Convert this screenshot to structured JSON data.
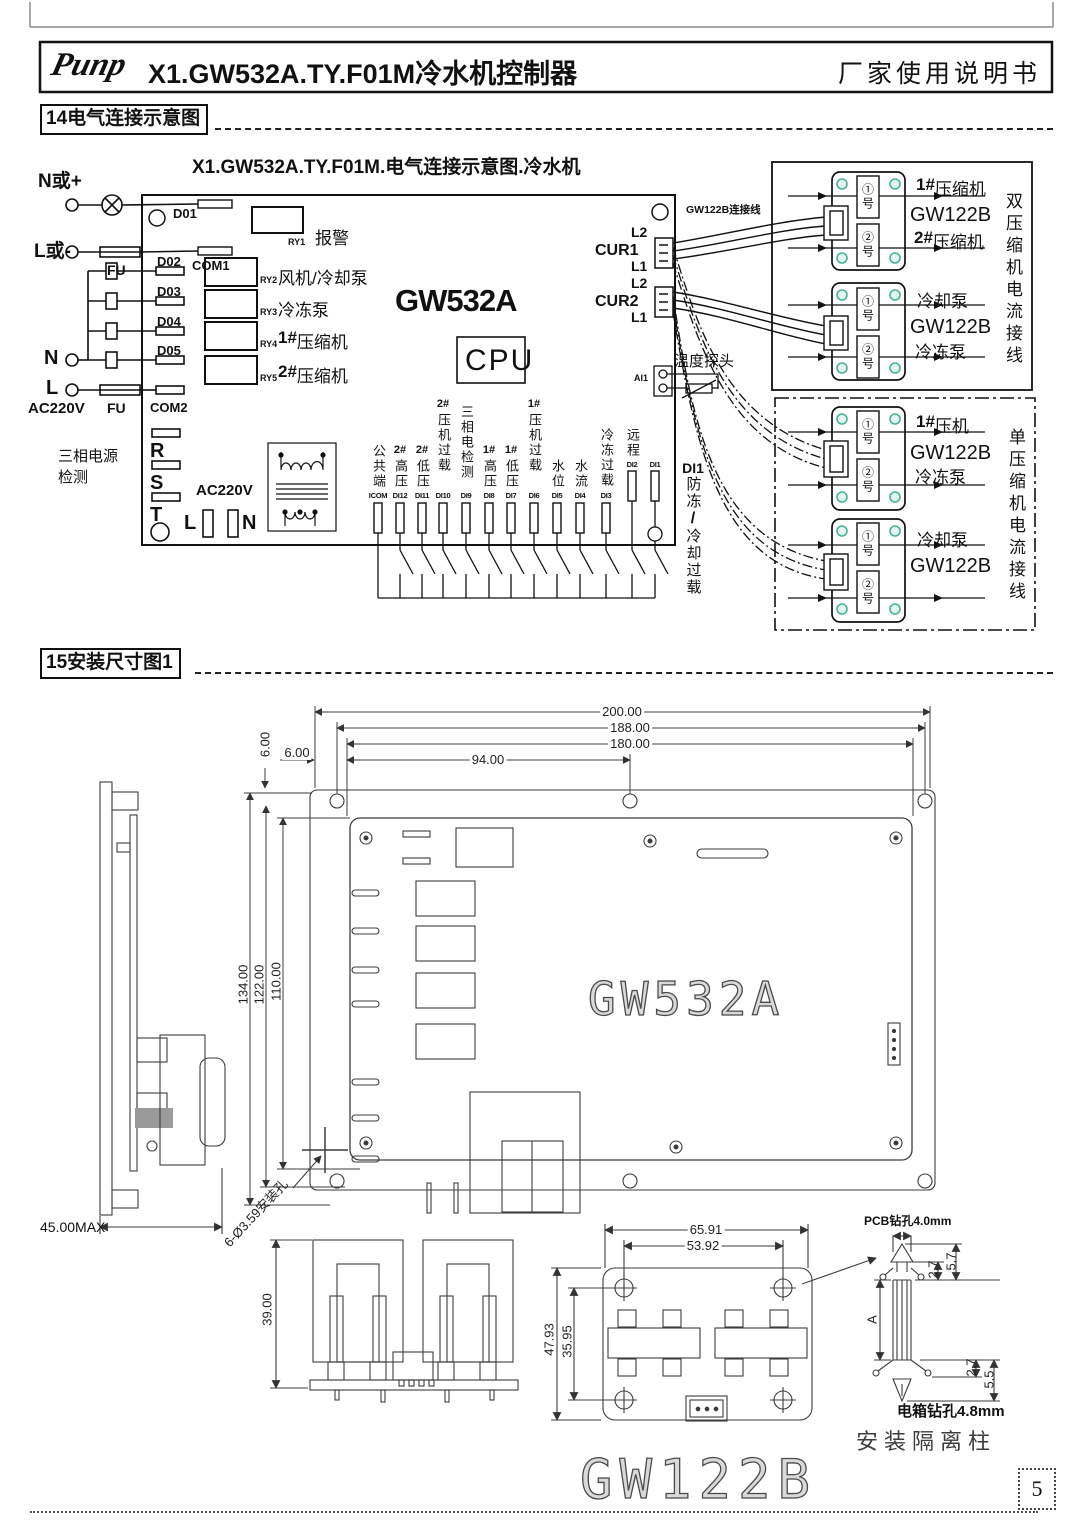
{
  "header": {
    "logo": "Punp",
    "title": "X1.GW532A.TY.F01M冷水机控制器",
    "manual": "厂家使用说明书"
  },
  "sec14": {
    "heading": "14电气连接示意图",
    "diagram_title": "X1.GW532A.TY.F01M.电气连接示意图.冷水机",
    "power": {
      "n_plus": "N或+",
      "l_minus": "L或-",
      "fu_top": "FU",
      "fu_bottom": "FU",
      "n": "N",
      "l": "L",
      "ac220v": "AC220V",
      "three_phase_1": "三相电源",
      "three_phase_2": "检测"
    },
    "board": {
      "name": "GW532A",
      "cpu": "CPU",
      "d01": "D01",
      "com1": "COM1",
      "d02": "D02",
      "d03": "D03",
      "d04": "D04",
      "d05": "D05",
      "com2": "COM2",
      "r": "R",
      "s": "S",
      "t": "T",
      "ac220v": "AC220V",
      "l": "L",
      "n": "N"
    },
    "relays": [
      {
        "id": "RY1",
        "prefix": "",
        "name": "报警"
      },
      {
        "id": "RY2",
        "prefix": "",
        "name": "风机/冷却泵"
      },
      {
        "id": "RY3",
        "prefix": "",
        "name": "冷冻泵"
      },
      {
        "id": "RY4",
        "prefix": "1#",
        "name": "压缩机"
      },
      {
        "id": "RY5",
        "prefix": "2#",
        "name": "压缩机"
      }
    ],
    "cur": {
      "cur1": "CUR1",
      "cur2": "CUR2",
      "l2a": "L2",
      "l1a": "L1",
      "l2b": "L2",
      "l1b": "L1",
      "cable": "GW122B连接线",
      "probe": "温度探头",
      "ai1": "AI1"
    },
    "di1_note": {
      "id": "DI1",
      "line1": "防冻",
      "slash": "/",
      "line2": "冷却过载"
    },
    "terminals": [
      {
        "prefix": "",
        "label": "公共端",
        "id": "ICOM"
      },
      {
        "prefix": "2#",
        "label": "高压",
        "id": "DI12"
      },
      {
        "prefix": "2#",
        "label": "低压",
        "id": "DI11"
      },
      {
        "prefix": "2#",
        "label": "压机过载",
        "id": "DI10"
      },
      {
        "prefix": "",
        "label": "三相电检测",
        "id": "DI9"
      },
      {
        "prefix": "1#",
        "label": "高压",
        "id": "DI8"
      },
      {
        "prefix": "1#",
        "label": "低压",
        "id": "DI7"
      },
      {
        "prefix": "1#",
        "label": "压机过载",
        "id": "DI6"
      },
      {
        "prefix": "",
        "label": "水位",
        "id": "DI5"
      },
      {
        "prefix": "",
        "label": "水流",
        "id": "DI4"
      },
      {
        "prefix": "",
        "label": "冷冻过载",
        "id": "DI3"
      },
      {
        "prefix": "",
        "label": "远程",
        "id": "DI2"
      },
      {
        "prefix": "",
        "label": "",
        "id": "DI1"
      }
    ],
    "panel_dual": {
      "side": "双压缩机电流接线",
      "modules": [
        {
          "win1": "①号",
          "win2": "②号",
          "label1_prefix": "1#",
          "label1": "压缩机",
          "name": "GW122B",
          "label2_prefix": "2#",
          "label2": "压缩机"
        },
        {
          "win1": "①号",
          "win2": "②号",
          "label1_prefix": "",
          "label1": "冷却泵",
          "name": "GW122B",
          "label2_prefix": "",
          "label2": "冷冻泵"
        }
      ]
    },
    "panel_single": {
      "side": "单压缩机电流接线",
      "modules": [
        {
          "win1": "①号",
          "win2": "②号",
          "label1_prefix": "1#",
          "label1": "压机",
          "name": "GW122B",
          "label2_prefix": "",
          "label2": "冷冻泵"
        },
        {
          "win1": "①号",
          "win2": "②号",
          "label1_prefix": "",
          "label1": "冷却泵",
          "name": "GW122B",
          "label2_prefix": "",
          "label2": ""
        }
      ]
    }
  },
  "sec15": {
    "heading": "15安装尺寸图1",
    "board_name": "GW532A",
    "gw122b_name": "GW122B",
    "dims": {
      "w200": "200.00",
      "w188": "188.00",
      "w180": "180.00",
      "w94": "94.00",
      "g6a": "6.00",
      "g6b": "6.00",
      "h134": "134.00",
      "h122": "122.00",
      "h110": "110.00",
      "max45": "45.00MAX",
      "holes": "6-Ø3.59安装孔",
      "h39": "39.00",
      "w6591": "65.91",
      "w5392": "53.92",
      "h4793": "47.93",
      "h3595": "35.95",
      "pcb": "PCB钻孔4.0mm",
      "a": "A",
      "r27a": "2.7",
      "r57": "5.7",
      "r27b": "2.7",
      "r55": "5.5",
      "box": "电箱钻孔4.8mm",
      "standoff": "安装隔离柱"
    }
  },
  "page_number": "5"
}
